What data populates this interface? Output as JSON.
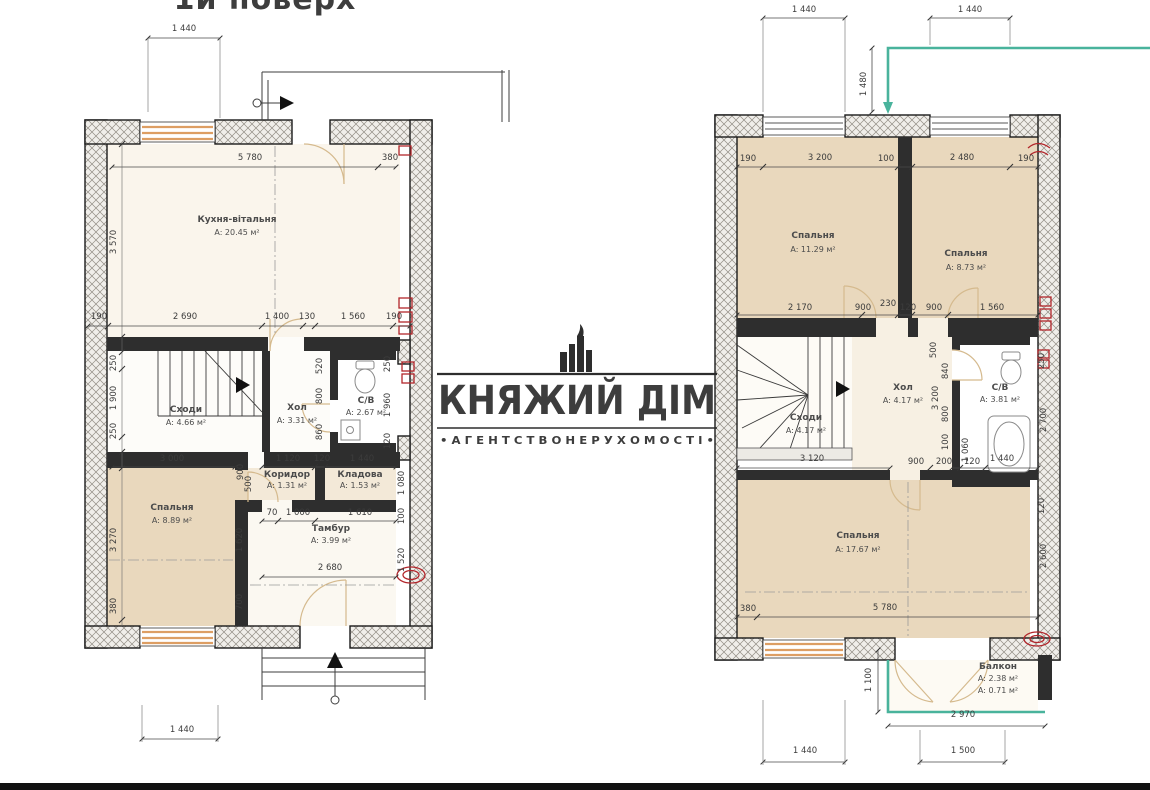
{
  "title": "1й поверх",
  "logo": {
    "name": "КНЯЖИЙ ДІМ",
    "tagline": "• А Г Е Н Т С Т В О   Н Е Р У Х О М О С Т І •"
  },
  "floor1": {
    "rooms": {
      "kitchen": {
        "name": "Кухня-вітальня",
        "area": "A: 20.45 м²"
      },
      "stairs": {
        "name": "Сходи",
        "area": "A: 4.66 м²"
      },
      "hall": {
        "name": "Хол",
        "area": "A: 3.31 м²"
      },
      "wc": {
        "name": "С/В",
        "area": "A: 2.67 м²"
      },
      "bedroom": {
        "name": "Спальня",
        "area": "A: 8.89 м²"
      },
      "corridor": {
        "name": "Коридор",
        "area": "A: 1.31 м²"
      },
      "storage": {
        "name": "Кладова",
        "area": "A: 1.53 м²"
      },
      "vestibule": {
        "name": "Тамбур",
        "area": "A: 3.99 м²"
      }
    },
    "dims": {
      "d1440_top": "1 440",
      "d5780": "5 780",
      "d380_top": "380",
      "d3570": "3 570",
      "row_mid": [
        "190",
        "2 690",
        "1 400",
        "130",
        "1 560",
        "190"
      ],
      "stairs_left": [
        "250",
        "1 900",
        "250"
      ],
      "stair_right": [
        "900",
        "500"
      ],
      "wc_left": [
        "520",
        "800",
        "860"
      ],
      "wc_right": [
        "250",
        "1 960",
        "120"
      ],
      "row_low": [
        "3 000",
        "1 120",
        "120",
        "1 440"
      ],
      "right_col": [
        "1 080",
        "100",
        "1 520"
      ],
      "row_vest": [
        "70",
        "1 000",
        "1 610"
      ],
      "bed_left": [
        "3 270",
        "380"
      ],
      "bed_inner": [
        "1 620",
        "700"
      ],
      "d2680": "2 680",
      "d1440_bottom": "1 440"
    }
  },
  "floor2": {
    "rooms": {
      "bedroom1": {
        "name": "Спальня",
        "area": "A: 11.29 м²"
      },
      "bedroom2": {
        "name": "Спальня",
        "area": "A: 8.73 м²"
      },
      "hall": {
        "name": "Хол",
        "area": "A: 4.17 м²"
      },
      "stairs": {
        "name": "Сходи",
        "area": "A: 4.17 м²"
      },
      "wc": {
        "name": "С/В",
        "area": "A: 3.81 м²"
      },
      "bedroom3": {
        "name": "Спальня",
        "area": "A: 17.67 м²"
      },
      "balcony": {
        "name": "Балкон",
        "area1": "A: 2.38 м²",
        "area2": "A: 0.71 м²"
      }
    },
    "dims": {
      "top": [
        "1 440",
        "1 440"
      ],
      "d1480": "1 480",
      "row_top": [
        "190",
        "3 200",
        "100",
        "2 480",
        "190"
      ],
      "row_bed": [
        "2 170",
        "900",
        "230",
        "120",
        "900",
        "1 560"
      ],
      "hall_col": [
        "500",
        "3 200"
      ],
      "wc_left": [
        "840",
        "800",
        "100",
        "1 060"
      ],
      "wc_right": [
        "250",
        "2 700"
      ],
      "row_mid": [
        "3 120",
        "900",
        "200",
        "120",
        "1 440"
      ],
      "bed3_right": [
        "120",
        "2 600"
      ],
      "row_bottom": [
        "380",
        "5 780"
      ],
      "d1100": "1 100",
      "d2970": "2 970",
      "d1500": "1 500",
      "d1440_bottom": "1 440"
    }
  }
}
